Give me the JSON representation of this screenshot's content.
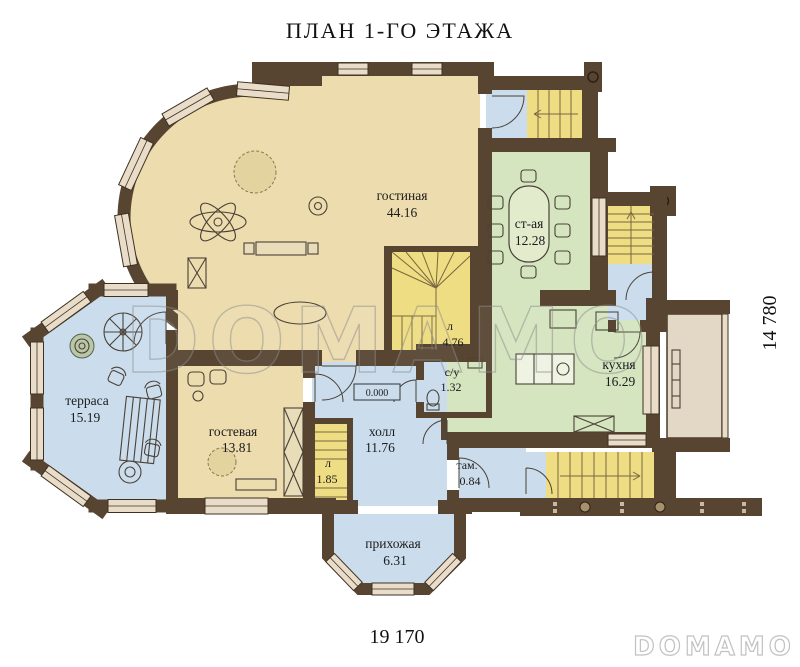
{
  "title": "ПЛАН 1-ГО ЭТАЖА",
  "rooms": [
    {
      "name": "гостиная",
      "area": "44.16"
    },
    {
      "name": "ст-ая",
      "area": "12.28"
    },
    {
      "name": "кухня",
      "area": "16.29"
    },
    {
      "name": "терраса",
      "area": "15.19"
    },
    {
      "name": "гостевая",
      "area": "13.81"
    },
    {
      "name": "холл",
      "area": "11.76"
    },
    {
      "name": "прихожая",
      "area": "6.31"
    },
    {
      "name": "там.",
      "area": "0.84"
    },
    {
      "name": "с/у",
      "area": "1.32"
    },
    {
      "name": "л",
      "area": "4.76"
    },
    {
      "name": "л",
      "area": "1.85"
    }
  ],
  "elevation_mark": "0.000",
  "dimensions": {
    "bottom": "19 170",
    "right": "14 780"
  },
  "watermark": "DOMAMO",
  "logo": "DOMAMO",
  "colors": {
    "wall": "#574531",
    "floor_beige": "#ecdcae",
    "floor_green": "#d5e5bf",
    "floor_blue": "#cbdded",
    "stairs_yellow": "#eedd82",
    "window": "#e9ddc9"
  }
}
